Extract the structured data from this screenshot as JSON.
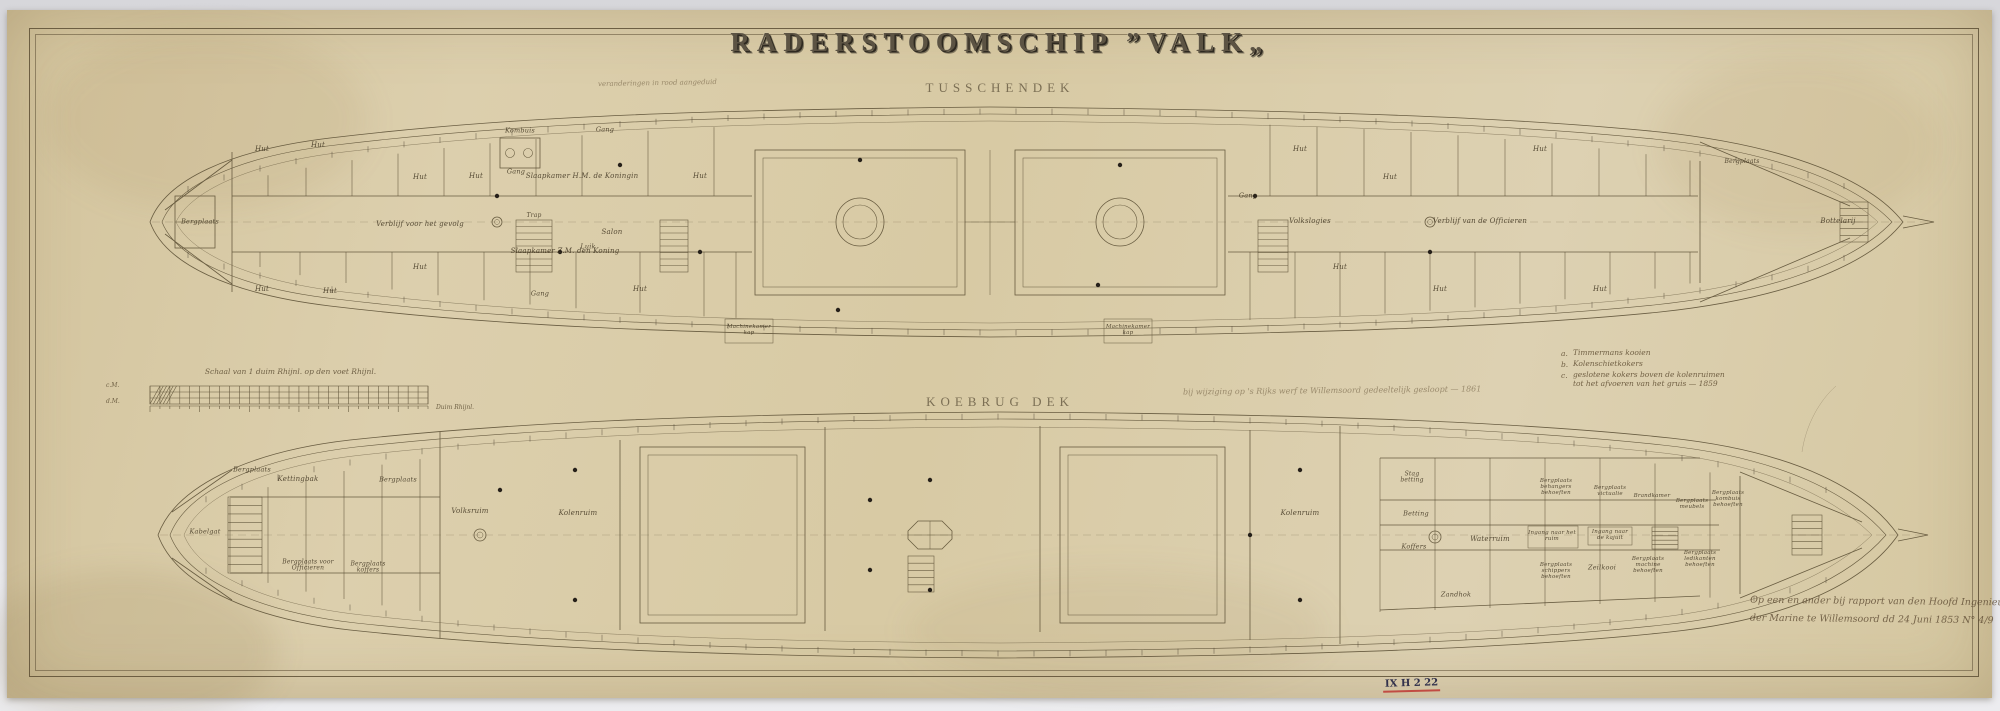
{
  "sheet": {
    "title": "RADERSTOOMSCHIP ”VALK„",
    "note_top_left": "veranderingen in rood aangeduid",
    "note_middle": "bij wijziging op 's Rijks werf te Willemsoord gedeeltelijk gesloopt — 1861",
    "inscription_line1": "Op een en ander bij rapport van den Hoofd Ingenieur",
    "inscription_line2": "der Marine te Willemsoord dd 24 Juni 1853 N° 4/9",
    "archive_mark": "IX H 2 22"
  },
  "decks": [
    {
      "label": "TUSSCHENDEK",
      "labels": [
        {
          "t": "Bergplaats",
          "x": 200,
          "y": 222,
          "s": 6.5
        },
        {
          "t": "Hut",
          "x": 262,
          "y": 150
        },
        {
          "t": "Hut",
          "x": 318,
          "y": 146
        },
        {
          "t": "Hut",
          "x": 420,
          "y": 178
        },
        {
          "t": "Hut",
          "x": 476,
          "y": 177
        },
        {
          "t": "Hut",
          "x": 700,
          "y": 177
        },
        {
          "t": "Hut",
          "x": 262,
          "y": 290
        },
        {
          "t": "Hut",
          "x": 330,
          "y": 292
        },
        {
          "t": "Hut",
          "x": 420,
          "y": 268
        },
        {
          "t": "Hut",
          "x": 640,
          "y": 290
        },
        {
          "t": "Hut",
          "x": 1300,
          "y": 150
        },
        {
          "t": "Hut",
          "x": 1390,
          "y": 178
        },
        {
          "t": "Hut",
          "x": 1340,
          "y": 268
        },
        {
          "t": "Hut",
          "x": 1440,
          "y": 290
        },
        {
          "t": "Hut",
          "x": 1540,
          "y": 150
        },
        {
          "t": "Hut",
          "x": 1600,
          "y": 290
        },
        {
          "t": "Gang",
          "x": 516,
          "y": 172,
          "s": 6.5
        },
        {
          "t": "Gang",
          "x": 605,
          "y": 130,
          "s": 6.5
        },
        {
          "t": "Gang",
          "x": 540,
          "y": 294,
          "s": 6.5
        },
        {
          "t": "Gang",
          "x": 1248,
          "y": 196,
          "s": 6.5
        },
        {
          "t": "Kombuis",
          "x": 520,
          "y": 131,
          "s": 6.5
        },
        {
          "t": "Slaapkamer H.M. de Koningin",
          "x": 582,
          "y": 177
        },
        {
          "t": "Slaapkamer Z.M. den Koning",
          "x": 565,
          "y": 252
        },
        {
          "t": "Verblijf voor het gevolg",
          "x": 420,
          "y": 225
        },
        {
          "t": "Salon",
          "x": 612,
          "y": 233
        },
        {
          "t": "Luik",
          "x": 588,
          "y": 247,
          "s": 6.5
        },
        {
          "t": "Trap",
          "x": 534,
          "y": 216,
          "s": 6
        },
        {
          "t": "Machinekamer kap",
          "x": 749,
          "y": 331,
          "s": 5.5,
          "w": 46
        },
        {
          "t": "Machinekamer kap",
          "x": 1128,
          "y": 331,
          "s": 5.5,
          "w": 46
        },
        {
          "t": "Volkslogies",
          "x": 1310,
          "y": 222
        },
        {
          "t": "Verblijf van de Officieren",
          "x": 1480,
          "y": 222
        },
        {
          "t": "Bottelarij",
          "x": 1838,
          "y": 222
        },
        {
          "t": "Bergplaats",
          "x": 1742,
          "y": 162,
          "s": 6
        }
      ]
    },
    {
      "label": "KOEBRUG DEK",
      "labels": [
        {
          "t": "Kabelgat",
          "x": 205,
          "y": 532,
          "s": 6.5
        },
        {
          "t": "Bergplaats",
          "x": 252,
          "y": 470,
          "s": 6.5
        },
        {
          "t": "Kettingbak",
          "x": 298,
          "y": 480
        },
        {
          "t": "Bergplaats voor Officieren",
          "x": 308,
          "y": 566,
          "w": 70,
          "s": 6
        },
        {
          "t": "Bergplaats koffers",
          "x": 368,
          "y": 568,
          "w": 52,
          "s": 6
        },
        {
          "t": "Bergplaats",
          "x": 398,
          "y": 480,
          "s": 6.5
        },
        {
          "t": "Volksruim",
          "x": 470,
          "y": 512
        },
        {
          "t": "Kolenruim",
          "x": 578,
          "y": 514
        },
        {
          "t": "Kolenruim",
          "x": 1300,
          "y": 514
        },
        {
          "t": "Waterruim",
          "x": 1490,
          "y": 540
        },
        {
          "t": "Ingang naar het ruim",
          "x": 1552,
          "y": 537,
          "w": 48,
          "s": 5.5
        },
        {
          "t": "Ingang naar de kajuit",
          "x": 1610,
          "y": 536,
          "w": 44,
          "s": 5.5
        },
        {
          "t": "Stag betting",
          "x": 1412,
          "y": 478,
          "w": 38,
          "s": 6
        },
        {
          "t": "Betting",
          "x": 1416,
          "y": 514,
          "s": 6.5
        },
        {
          "t": "Koffers",
          "x": 1414,
          "y": 547,
          "s": 6.5
        },
        {
          "t": "Zandhok",
          "x": 1456,
          "y": 595,
          "s": 6.5
        },
        {
          "t": "Bergplaats behangers behoeften",
          "x": 1556,
          "y": 488,
          "w": 55,
          "s": 5.5
        },
        {
          "t": "Bergplaats victualie",
          "x": 1610,
          "y": 492,
          "w": 50,
          "s": 5.5
        },
        {
          "t": "Brandkamer",
          "x": 1652,
          "y": 497,
          "w": 40,
          "s": 5.5
        },
        {
          "t": "Bergplaats meubels",
          "x": 1692,
          "y": 505,
          "w": 45,
          "s": 5.5
        },
        {
          "t": "Bergplaats kombuis behoeften",
          "x": 1728,
          "y": 500,
          "w": 52,
          "s": 5.5
        },
        {
          "t": "Bergplaats schippers behoeften",
          "x": 1556,
          "y": 572,
          "w": 55,
          "s": 5.5
        },
        {
          "t": "Zeilkooi",
          "x": 1602,
          "y": 568,
          "s": 6.5
        },
        {
          "t": "Bergplaats machine behoeften",
          "x": 1648,
          "y": 566,
          "w": 50,
          "s": 5.5
        },
        {
          "t": "Bergplaats ledikanten behoeften",
          "x": 1700,
          "y": 560,
          "w": 55,
          "s": 5.5
        }
      ]
    }
  ],
  "scale_bar": {
    "caption": "Schaal van 1 duim Rhijnl. op den voet Rhijnl.",
    "row_labels": [
      "c.M.",
      "d.M."
    ],
    "end_label": "Duim Rhijnl."
  },
  "legend": {
    "items": [
      {
        "key": "a.",
        "text": "Timmermans kooien",
        "text2": ""
      },
      {
        "key": "b.",
        "text": "Kolenschietkokers",
        "text2": ""
      },
      {
        "key": "c.",
        "text": "geslotene kokers boven de kolenruimen",
        "text2": "tot het afvoeren van het gruis — 1859"
      }
    ]
  }
}
